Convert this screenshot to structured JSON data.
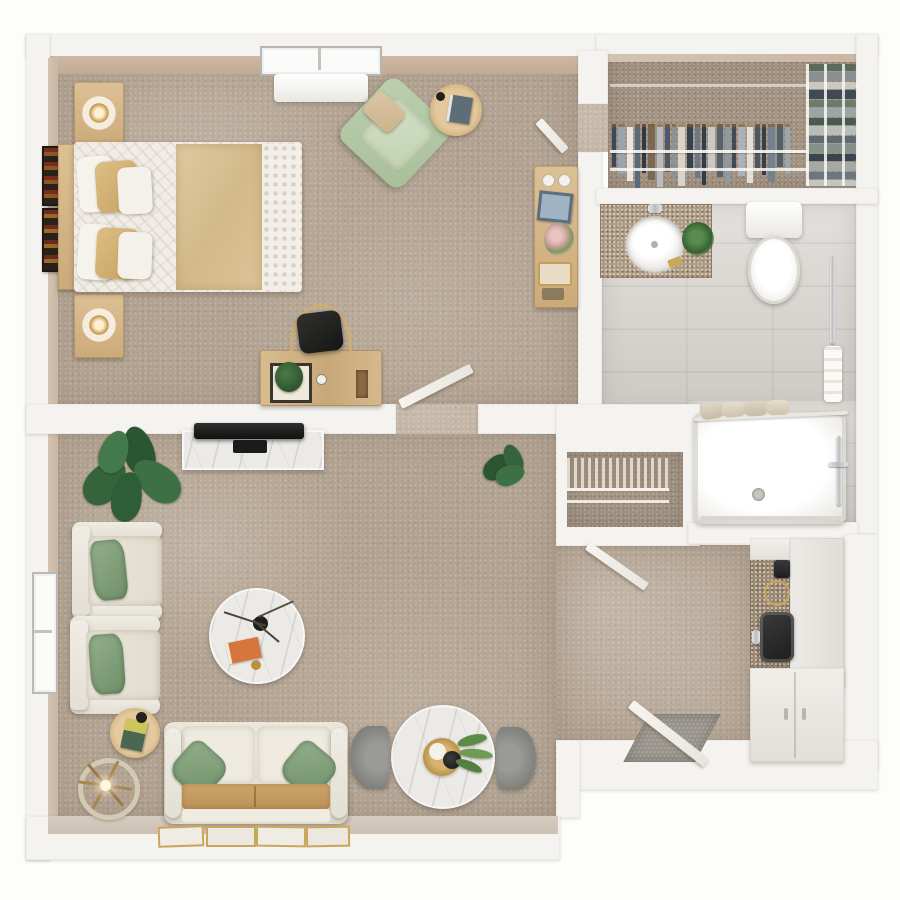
{
  "title": "studio-apartment-floor-plan-top-view",
  "palette": {
    "background": "#fdfdfc",
    "wall_white": "#f5f3f0",
    "wall_tan_face": "#c7b19d",
    "carpet": "#b2a291",
    "tile": "#d8d4cf",
    "wood": "#d2b488",
    "marble": "#eceae6",
    "sage_green": "#8fae8a",
    "duvet_tan": "#d9c292",
    "upholstery_cream": "#e9e3d8",
    "seat_tan": "#c49a62",
    "granite": "#ae9d88",
    "entry_mat_grey": "#98948c"
  },
  "rooms": [
    {
      "name": "bedroom",
      "floor": "carpet",
      "furniture": [
        "bed",
        "headboard",
        "pillows",
        "tan-duvet",
        "nightstand-top",
        "nightstand-bottom",
        "table-lamp",
        "table-lamp",
        "wall-art",
        "wall-art",
        "green-armchair",
        "round-side-table",
        "desk",
        "desk-chair",
        "desk-plant",
        "dresser",
        "window",
        "heater-unit",
        "door-to-closet",
        "door-to-living"
      ]
    },
    {
      "name": "closet",
      "floor": "carpet",
      "furniture": [
        "wire-shelf-rails",
        "hanging-clothes",
        "folded-clothes-stacks"
      ]
    },
    {
      "name": "bathroom",
      "floor": "tile",
      "furniture": [
        "vanity-counter",
        "round-sink",
        "faucet",
        "vanity-plant",
        "toilet",
        "grab-bar",
        "towel"
      ]
    },
    {
      "name": "shower-room",
      "floor": "tile",
      "furniture": [
        "shower-tray",
        "drain",
        "curtain-rod",
        "rolled-towels",
        "shower-fixtures",
        "glass-track"
      ]
    },
    {
      "name": "linen-closet",
      "floor": "carpet",
      "furniture": [
        "wire-shelves"
      ]
    },
    {
      "name": "living-room",
      "floor": "carpet",
      "furniture": [
        "tv-console",
        "tv",
        "large-plant",
        "small-plant",
        "armchair",
        "armchair",
        "floor-lamp",
        "small-round-table",
        "coffee-table",
        "sofa",
        "green-pillows",
        "wall-art-frames",
        "dining-table",
        "dining-chair",
        "dining-chair",
        "window",
        "door-to-hall",
        "entry-door",
        "entry-mat"
      ]
    },
    {
      "name": "kitchenette",
      "floor": "carpet",
      "furniture": [
        "granite-counter",
        "coffee-maker",
        "burner",
        "black-sink",
        "white-counter",
        "base-cabinets"
      ]
    }
  ],
  "closet": {
    "hanging_colors": [
      "#3a4a5a",
      "#9aa4ac",
      "#e8e6e0",
      "#5a6a78",
      "#2e3a46",
      "#7a6a55",
      "#b8bcc0",
      "#4a5a6a",
      "#8a929a",
      "#d8d4cc",
      "#36424e",
      "#6b7888",
      "#2f3d4a",
      "#c9c9c4",
      "#56636f",
      "#8d9aa5",
      "#3d4c58",
      "#aab2b8",
      "#e2dfd8",
      "#49586466",
      "#32404c",
      "#75828e",
      "#50606c",
      "#9ba6ae"
    ],
    "folded_colors": [
      "#5a6a5d",
      "#8a8f93",
      "#c9c9c4",
      "#3f4a52",
      "#6e7a6e",
      "#9aa5a8",
      "#4a5a52",
      "#b9bdb9",
      "#5d6b75",
      "#87918b",
      "#39454e",
      "#a3aaa6",
      "#6a7680",
      "#c2c5c0"
    ]
  },
  "coffee_table_items": [
    "branch-vase",
    "orange-book",
    "gold-coaster"
  ],
  "dining_table_items": [
    "gold-tray",
    "plate",
    "black-teapot",
    "green-sprigs"
  ]
}
